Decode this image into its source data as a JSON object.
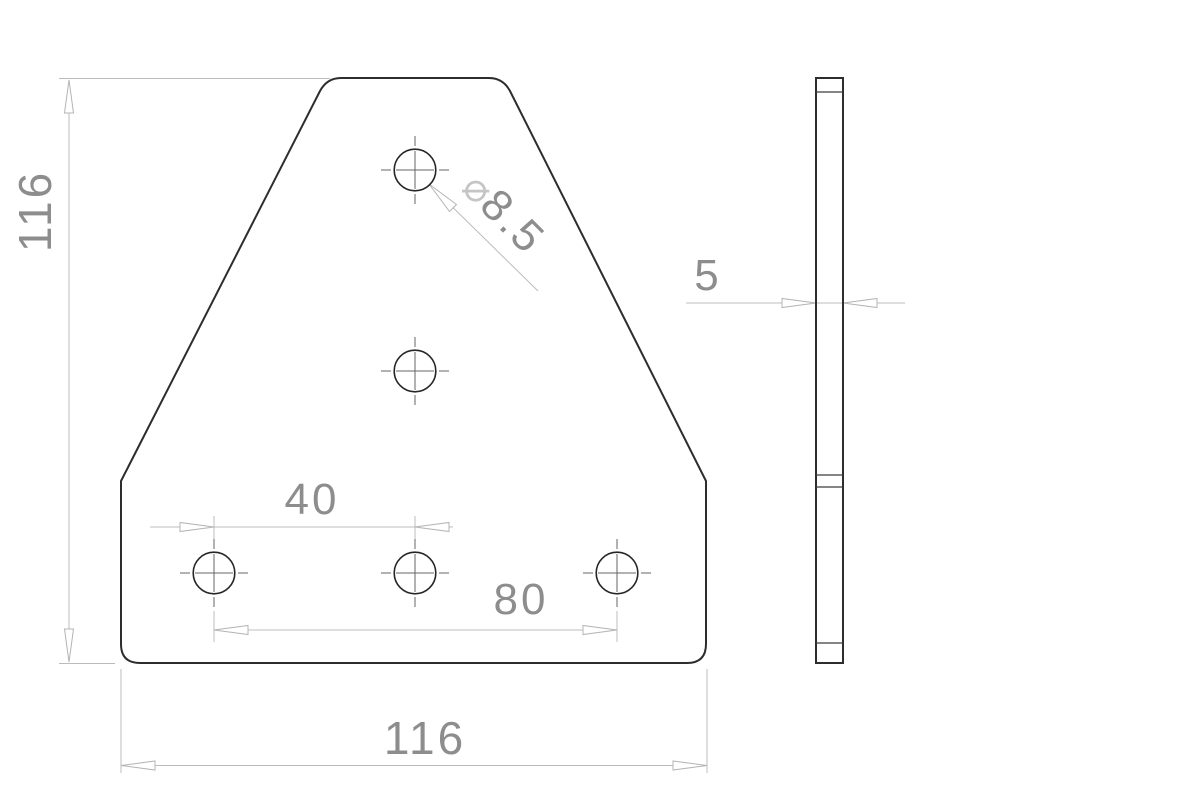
{
  "drawing": {
    "dimensions": {
      "overall_height": "116",
      "overall_width": "116",
      "hole_pitch_small": "40",
      "hole_pitch_large": "80",
      "diameter_symbol": "⌀",
      "hole_diameter": "8.5",
      "thickness": "5"
    },
    "colors": {
      "background": "#ffffff",
      "part_outline": "#2d2d2d",
      "dimension_lines": "#bcbcbc",
      "dimension_text": "#8d8d8d",
      "centerlines": "#666666"
    }
  }
}
